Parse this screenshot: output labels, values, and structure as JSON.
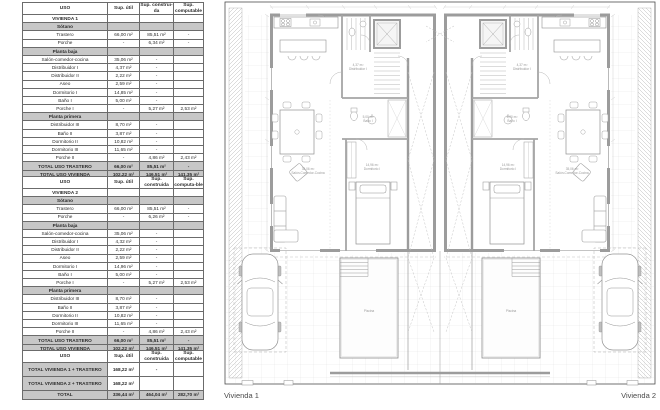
{
  "tables": [
    {
      "name": "vivienda-1-table",
      "headers": [
        "USO",
        "Sup. útil",
        "Sup. construi-da",
        "Sup. computable"
      ],
      "rows": [
        {
          "type": "title",
          "cells": [
            "VIVIENDA 1",
            "",
            "",
            ""
          ]
        },
        {
          "type": "section",
          "cells": [
            "Sótano",
            "",
            "",
            ""
          ]
        },
        {
          "type": "data",
          "cells": [
            "Trastero",
            "66,00 m²",
            "85,51 m²",
            "-"
          ]
        },
        {
          "type": "data",
          "cells": [
            "Porche",
            "-",
            "6,34 m²",
            "-"
          ]
        },
        {
          "type": "section",
          "cells": [
            "Planta baja",
            "",
            "",
            ""
          ]
        },
        {
          "type": "data",
          "cells": [
            "Salón-comedor-cocina",
            "35,06 m²",
            "-",
            ""
          ]
        },
        {
          "type": "data",
          "cells": [
            "Distribuidor I",
            "4,37 m²",
            "-",
            ""
          ]
        },
        {
          "type": "data",
          "cells": [
            "Distribuidor II",
            "2,22 m²",
            "-",
            ""
          ]
        },
        {
          "type": "data",
          "cells": [
            "Aseo",
            "2,59 m²",
            "-",
            ""
          ]
        },
        {
          "type": "data",
          "cells": [
            "Dormitorio I",
            "14,85 m²",
            "-",
            ""
          ]
        },
        {
          "type": "data",
          "cells": [
            "Baño I",
            "5,00 m²",
            "-",
            ""
          ]
        },
        {
          "type": "data",
          "cells": [
            "Porche I",
            "-",
            "5,27 m²",
            "2,53 m²"
          ]
        },
        {
          "type": "section",
          "cells": [
            "Planta primera",
            "",
            "",
            ""
          ]
        },
        {
          "type": "data",
          "cells": [
            "Distribuidor III",
            "8,70 m²",
            "-",
            ""
          ]
        },
        {
          "type": "data",
          "cells": [
            "Baño II",
            "3,87 m²",
            "-",
            ""
          ]
        },
        {
          "type": "data",
          "cells": [
            "Dormitorio II",
            "10,82 m²",
            "-",
            ""
          ]
        },
        {
          "type": "data",
          "cells": [
            "Dormitorio III",
            "11,65 m²",
            "-",
            ""
          ]
        },
        {
          "type": "data",
          "cells": [
            "Porche II",
            "-",
            "4,86 m²",
            "2,43 m²"
          ]
        },
        {
          "type": "total",
          "cells": [
            "TOTAL USO TRASTERO",
            "66,00 m²",
            "85,51 m²",
            "-"
          ]
        },
        {
          "type": "total",
          "cells": [
            "TOTAL USO VIVIENDA",
            "102,22 m²",
            "146,51 m²",
            "141,35 m²"
          ]
        }
      ]
    },
    {
      "name": "vivienda-2-table",
      "headers": [
        "USO",
        "Sup. útil",
        "Sup. construida",
        "Sup. computa-ble"
      ],
      "rows": [
        {
          "type": "title",
          "cells": [
            "VIVIENDA 2",
            "",
            "",
            ""
          ]
        },
        {
          "type": "section",
          "cells": [
            "Sótano",
            "",
            "",
            ""
          ]
        },
        {
          "type": "data",
          "cells": [
            "Trastero",
            "66,00 m²",
            "85,51 m²",
            "-"
          ]
        },
        {
          "type": "data",
          "cells": [
            "Porche",
            "-",
            "6,26 m²",
            "-"
          ]
        },
        {
          "type": "section",
          "cells": [
            "Planta baja",
            "",
            "",
            ""
          ]
        },
        {
          "type": "data",
          "cells": [
            "Salón-comedor-cocina",
            "35,06 m²",
            "-",
            ""
          ]
        },
        {
          "type": "data",
          "cells": [
            "Distribuidor I",
            "4,32 m²",
            "-",
            ""
          ]
        },
        {
          "type": "data",
          "cells": [
            "Distribuidor II",
            "2,22 m²",
            "-",
            ""
          ]
        },
        {
          "type": "data",
          "cells": [
            "Aseo",
            "2,59 m²",
            "-",
            ""
          ]
        },
        {
          "type": "data",
          "cells": [
            "Dormitorio I",
            "14,96 m²",
            "-",
            ""
          ]
        },
        {
          "type": "data",
          "cells": [
            "Baño I",
            "5,00 m²",
            "-",
            ""
          ]
        },
        {
          "type": "data",
          "cells": [
            "Porche I",
            "-",
            "5,27 m²",
            "2,53 m²"
          ]
        },
        {
          "type": "section",
          "cells": [
            "Planta primera",
            "",
            "",
            ""
          ]
        },
        {
          "type": "data",
          "cells": [
            "Distribuidor III",
            "8,70 m²",
            "-",
            ""
          ]
        },
        {
          "type": "data",
          "cells": [
            "Baño II",
            "3,87 m²",
            "-",
            ""
          ]
        },
        {
          "type": "data",
          "cells": [
            "Dormitorio II",
            "10,82 m²",
            "-",
            ""
          ]
        },
        {
          "type": "data",
          "cells": [
            "Dormitorio III",
            "11,65 m²",
            "-",
            ""
          ]
        },
        {
          "type": "data",
          "cells": [
            "Porche II",
            "-",
            "4,86 m²",
            "2,43 m²"
          ]
        },
        {
          "type": "total",
          "cells": [
            "TOTAL USO TRASTERO",
            "66,00 m²",
            "85,51 m²",
            "-"
          ]
        },
        {
          "type": "total",
          "cells": [
            "TOTAL USO VIVIENDA",
            "102,22 m²",
            "146,51 m²",
            "141,35 m²"
          ]
        }
      ]
    },
    {
      "name": "summary-table",
      "headers": [
        "USO",
        "Sup. útil",
        "Sup. construida",
        "Sup. computable"
      ],
      "rows": [
        {
          "type": "total2",
          "cells": [
            "TOTAL VIVIENDA 1 + TRASTERO",
            "168,22 m²",
            "-",
            ""
          ]
        },
        {
          "type": "total2",
          "cells": [
            "TOTAL VIVIENDA 2 + TRASTERO",
            "168,22 m²",
            "",
            ""
          ]
        },
        {
          "type": "total",
          "cells": [
            "TOTAL",
            "336,44 m²",
            "464,04 m²",
            "282,70 m²"
          ]
        }
      ]
    }
  ],
  "plan": {
    "label_left": "Vivienda 1",
    "label_right": "Vivienda 2",
    "room_labels": [
      {
        "area": "35,06 m²",
        "text": "Salón-Comedor-Cocina",
        "x": 86,
        "y": 170
      },
      {
        "area": "4,37 m²",
        "text": "Distribuidor I",
        "x": 136,
        "y": 66
      },
      {
        "area": "5,00 m²",
        "text": "Baño I",
        "x": 146,
        "y": 118
      },
      {
        "area": "14,96 m²",
        "text": "Dormitorio I",
        "x": 150,
        "y": 166
      },
      {
        "area": "",
        "text": "Piscina",
        "x": 147,
        "y": 312
      }
    ],
    "colors": {
      "wall": "#9c9c9c",
      "tile": "#e2e2e2",
      "furniture": "#8f8f8f",
      "dash": "#bdbdbd"
    }
  }
}
